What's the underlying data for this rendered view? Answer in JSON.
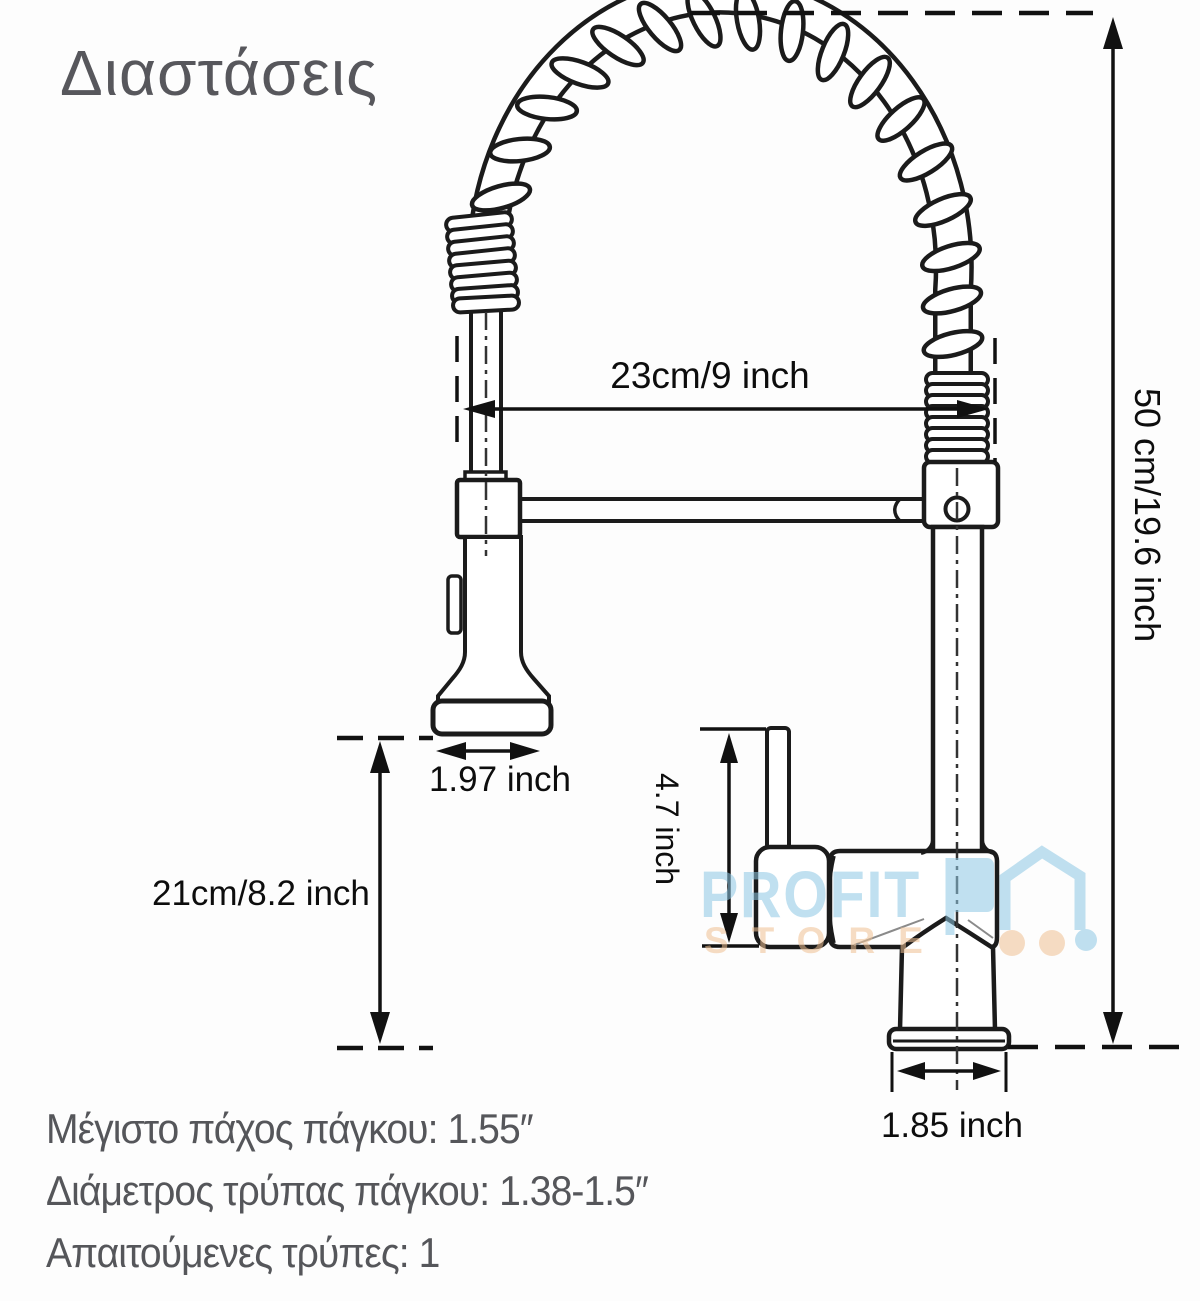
{
  "title": "Διαστάσεις",
  "dimensions": {
    "spout_reach": "23cm/9 inch",
    "total_height": "50 cm/19.6 inch",
    "spray_head_width": "1.97 inch",
    "spray_clearance_height": "21cm/8.2 inch",
    "handle_height": "4.7 inch",
    "base_width": "1.85 inch"
  },
  "notes": [
    "Μέγιστο πάχος πάγκου: 1.55″",
    "Διάμετρος τρύπας πάγκου: 1.38-1.5″",
    "Απαιτούμενες τρύπες: 1"
  ],
  "watermark": {
    "line1": "PROFIT",
    "line2": "STORE"
  },
  "colors": {
    "line": "#1b1b1b",
    "dimension_text": "#0d0d0d",
    "label_gray": "#55565a",
    "watermark_blue": "#8ec8e4",
    "watermark_orange": "#f0c193"
  }
}
